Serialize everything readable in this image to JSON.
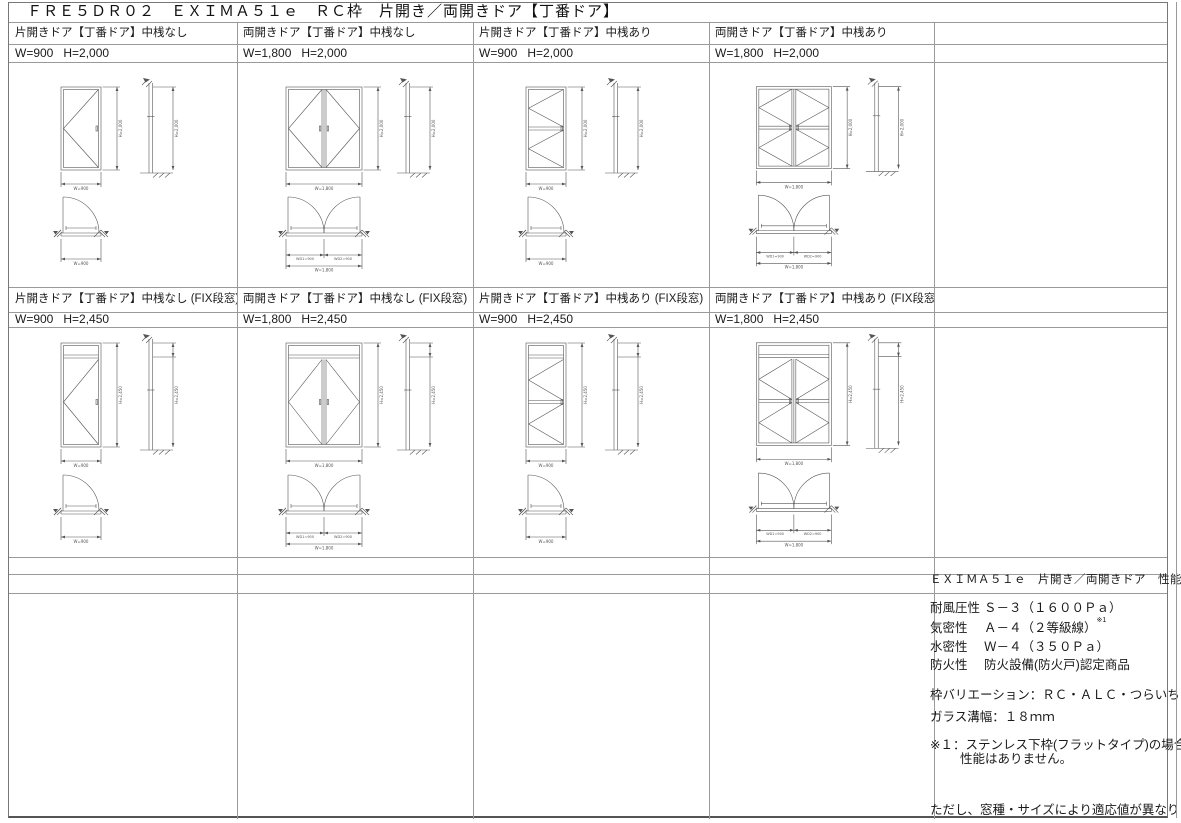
{
  "title": "ＦＲＥ５ＤＲ０２　ＥＸＩＭＡ５１ｅ　ＲＣ枠　片開き／両開きドア【丁番ドア】",
  "colors": {
    "grid_line": "#9a9a9a",
    "outer_border": "#777777",
    "drawing_line": "#555555",
    "text": "#1a1a1a"
  },
  "cells": [
    {
      "caption": "片開きドア【丁番ドア】中桟なし",
      "size": "W=900   H=2,000",
      "drawing": {
        "leaves": 1,
        "midrail": false,
        "fix": false,
        "labels": {
          "el_h": "H=2,000",
          "el_w": "W=900",
          "sec_h": "H=2,000",
          "plan_w": "W=900"
        }
      }
    },
    {
      "caption": "両開きドア【丁番ドア】中桟なし",
      "size": "W=1,800   H=2,000",
      "drawing": {
        "leaves": 2,
        "midrail": false,
        "fix": false,
        "labels": {
          "el_h": "H=2,000",
          "el_w": "W=1,800",
          "sec_h": "H=2,000",
          "plan_w": "W=1,800",
          "plan_half1": "WD1=900",
          "plan_half2": "WD2=900"
        }
      }
    },
    {
      "caption": "片開きドア【丁番ドア】中桟あり",
      "size": "W=900   H=2,000",
      "drawing": {
        "leaves": 1,
        "midrail": true,
        "fix": false,
        "labels": {
          "el_h": "H=2,000",
          "el_w": "W=900",
          "sec_h": "H=2,000",
          "plan_w": "W=900"
        }
      }
    },
    {
      "caption": "両開きドア【丁番ドア】中桟あり",
      "size": "W=1,800   H=2,000",
      "drawing": {
        "leaves": 2,
        "midrail": true,
        "fix": false,
        "labels": {
          "el_h": "H=2,000",
          "el_w": "W=1,800",
          "sec_h": "H=2,000",
          "plan_w": "W=1,800",
          "plan_half1": "WD1=900",
          "plan_half2": "WD2=900"
        }
      }
    },
    {
      "caption": "片開きドア【丁番ドア】中桟なし (FIX段窓)",
      "size": "W=900   H=2,450",
      "drawing": {
        "leaves": 1,
        "midrail": false,
        "fix": true,
        "labels": {
          "el_h": "H=2,450",
          "el_w": "W=900",
          "sec_h": "H=2,450",
          "plan_w": "W=900"
        }
      }
    },
    {
      "caption": "両開きドア【丁番ドア】中桟なし (FIX段窓)",
      "size": "W=1,800   H=2,450",
      "drawing": {
        "leaves": 2,
        "midrail": false,
        "fix": true,
        "labels": {
          "el_h": "H=2,450",
          "el_w": "W=1,800",
          "sec_h": "H=2,450",
          "plan_w": "W=1,800",
          "plan_half1": "WD1=900",
          "plan_half2": "WD2=900"
        }
      }
    },
    {
      "caption": "片開きドア【丁番ドア】中桟あり (FIX段窓)",
      "size": "W=900   H=2,450",
      "drawing": {
        "leaves": 1,
        "midrail": true,
        "fix": true,
        "labels": {
          "el_h": "H=2,450",
          "el_w": "W=900",
          "sec_h": "H=2,450",
          "plan_w": "W=900"
        }
      }
    },
    {
      "caption": "両開きドア【丁番ドア】中桟あり (FIX段窓)",
      "size": "W=1,800   H=2,450",
      "drawing": {
        "leaves": 2,
        "midrail": true,
        "fix": true,
        "labels": {
          "el_h": "H=2,450",
          "el_w": "W=1,800",
          "sec_h": "H=2,450",
          "plan_w": "W=1,800",
          "plan_half1": "WD1=900",
          "plan_half2": "WD2=900"
        }
      }
    }
  ],
  "spec": {
    "title": "ＥＸＩＭＡ５１ｅ　片開き／両開きドア　性能等級",
    "rows": [
      {
        "label": "耐風圧性",
        "value": "Ｓ－３（１６００Ｐａ）",
        "sup": ""
      },
      {
        "label": "気密性",
        "value": "Ａ－４（２等級線）",
        "sup": "※1"
      },
      {
        "label": "水密性",
        "value": "Ｗ－４（３５０Ｐａ）",
        "sup": ""
      },
      {
        "label": "防火性",
        "value": "防火設備(防火戸)認定商品",
        "sup": ""
      }
    ],
    "frame_variation": "枠バリエーション：ＲＣ・ＡＬＣ・つらいち",
    "glass_groove": "ガラス溝幅：１８ｍｍ",
    "note1_line1": "※１：ステンレス下枠(フラットタイプ)の場合、",
    "note1_line2": "性能はありません。",
    "footnote": "ただし、窓種・サイズにより適応値が異なります。"
  }
}
